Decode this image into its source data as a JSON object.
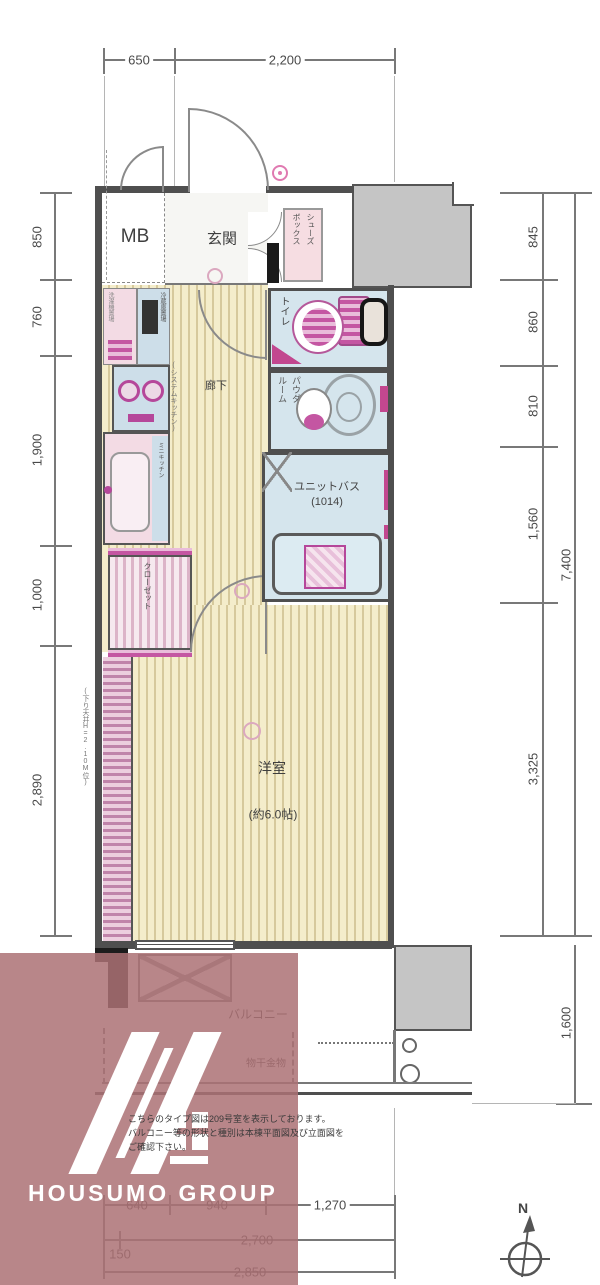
{
  "plan": {
    "rooms": {
      "mb": "MB",
      "entrance": "玄関",
      "shoebox_right": "シューズ",
      "shoebox_left": "ボックス",
      "toilet": "トイレ",
      "powder_right": "パウダ",
      "powder_left": "ルーム",
      "bath_line1": "ユニットバス",
      "bath_line2": "(1014)",
      "corridor": "廊下",
      "kitchen_note": "(システムキッチン)",
      "washer": "洗濯機置場",
      "fridge": "冷蔵庫置場",
      "kitchen_strip": "ミニキッチン",
      "closet": "クローゼット",
      "ceiling_note": "(下り天井H=2.10M位)",
      "main_room": "洋室",
      "main_room_size": "(約6.0帖)",
      "balcony": "バルコニー",
      "laundry": "物干金物"
    },
    "dims": {
      "top": [
        "650",
        "2,200"
      ],
      "left": [
        "850",
        "760",
        "1,900",
        "1,000",
        "2,890"
      ],
      "right": [
        "845",
        "860",
        "810",
        "1,560",
        "3,325"
      ],
      "right_total": "7,400",
      "balcony_depth": "1,600",
      "bottom1": [
        "640",
        "940",
        "1,270"
      ],
      "bottom2": [
        "150",
        "2,700"
      ],
      "bottom3": "2,850"
    },
    "compass": "N"
  },
  "notes": {
    "line1": "こちらのタイプ図は209号室を表示しております。",
    "line2": "バルコニー等の形状と種別は本棟平面図及び立面図を",
    "line3": "ご確認下さい。"
  },
  "logo": {
    "text": "HOUSUMO GROUP"
  },
  "colors": {
    "overlay": "#ac7174",
    "water_room": "#d5e5ed",
    "floor_wood": "#f4edcb",
    "accent_pink": "#c2478f",
    "gray_block": "#c5c5c5"
  }
}
